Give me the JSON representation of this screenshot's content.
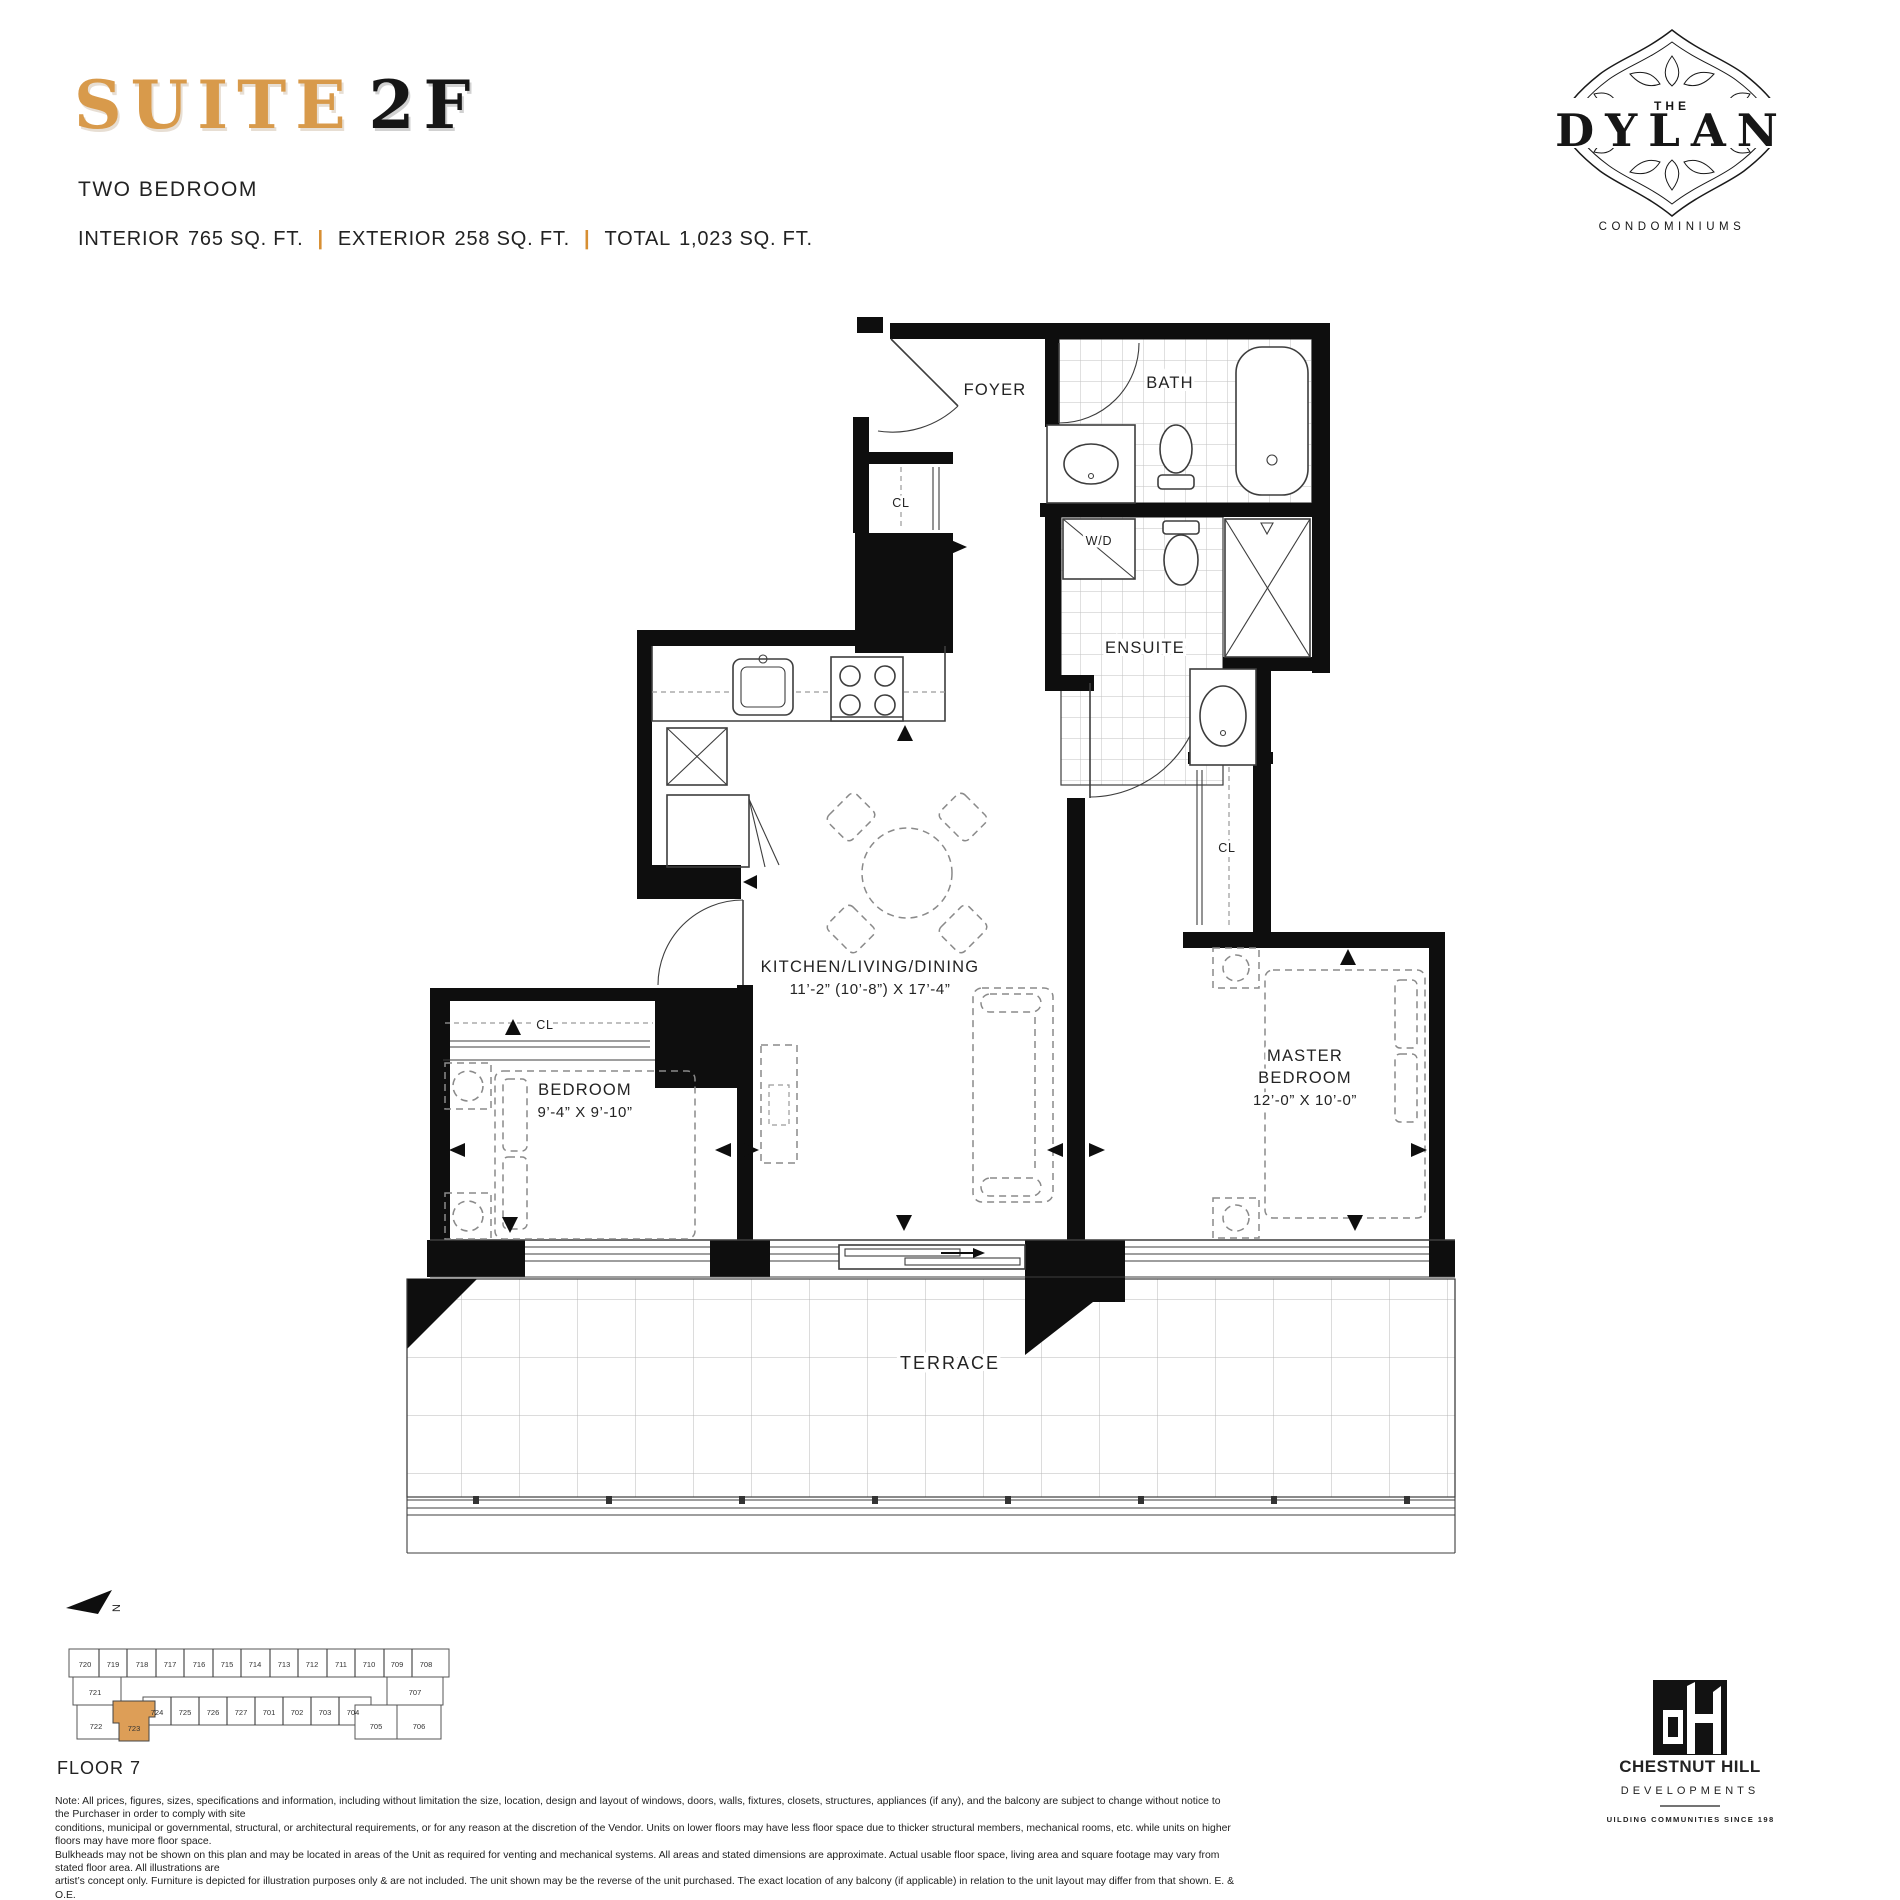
{
  "header": {
    "suite_label": "SUITE",
    "suite_code": "2F",
    "type": "TWO BEDROOM",
    "stats": {
      "interior_label": "INTERIOR",
      "interior_value": "765 SQ. FT.",
      "exterior_label": "EXTERIOR",
      "exterior_value": "258 SQ. FT.",
      "total_label": "TOTAL",
      "total_value": "1,023 SQ. FT.",
      "divider": "|"
    }
  },
  "brand": {
    "the": "THE",
    "name": "DYLAN",
    "descriptor": "CONDOMINIUMS"
  },
  "floorplan": {
    "foyer": "FOYER",
    "bath": "BATH",
    "wd": "W/D",
    "ensuite": "ENSUITE",
    "cl": "CL",
    "kld_name": "KITCHEN/LIVING/DINING",
    "kld_dims": "11’-2” (10’-8”) X 17’-4”",
    "bedroom_name": "BEDROOM",
    "bedroom_dims": "9’-4” X 9’-10”",
    "master_line1": "MASTER",
    "master_line2": "BEDROOM",
    "master_dims": "12’-0” X 10’-0”",
    "terrace": "TERRACE"
  },
  "keyplan": {
    "floor_label": "FLOOR 7",
    "north_label": "N",
    "top_row": [
      "720",
      "719",
      "718",
      "717",
      "716",
      "715",
      "714",
      "713",
      "712",
      "711",
      "710",
      "709",
      "708"
    ],
    "left_unit": "721",
    "right_unit": "707",
    "middle_row": [
      "724",
      "725",
      "726",
      "727",
      "701",
      "702",
      "703",
      "704"
    ],
    "bottom_left": [
      "722",
      "723"
    ],
    "bottom_right": [
      "705",
      "706"
    ],
    "highlight_color": "#dd9e57"
  },
  "developer": {
    "name": "CHESTNUT HILL",
    "division": "DEVELOPMENTS",
    "tagline": "BUILDING COMMUNITIES SINCE 1981"
  },
  "disclaimer": {
    "lines": [
      "Note:  All prices, figures, sizes, specifications and information, including without limitation the size, location, design and layout of windows, doors, walls, fixtures, closets, structures, appliances (if any), and the balcony are subject to change without notice to the Purchaser in order to comply with site",
      "conditions, municipal or governmental, structural, or architectural requirements, or for any reason at the discretion of the Vendor. Units on lower floors may have less floor space due to thicker structural members, mechanical rooms, etc. while units on higher floors may have more floor space.",
      "Bulkheads may not be shown on this plan and may be located in areas of the Unit as required for venting and mechanical systems. All areas and stated dimensions are approximate. Actual usable floor space, living area and square footage may vary from stated floor area. All illustrations are",
      "artist’s concept only. Furniture is depicted for illustration purposes only & are not included. The unit shown may be the reverse of the unit purchased. The exact location of any balcony (if applicable) in relation to the unit layout may differ from that shown. E. & O.E."
    ]
  },
  "colors": {
    "accent": "#d89a4b",
    "ink": "#1d1d1b"
  }
}
